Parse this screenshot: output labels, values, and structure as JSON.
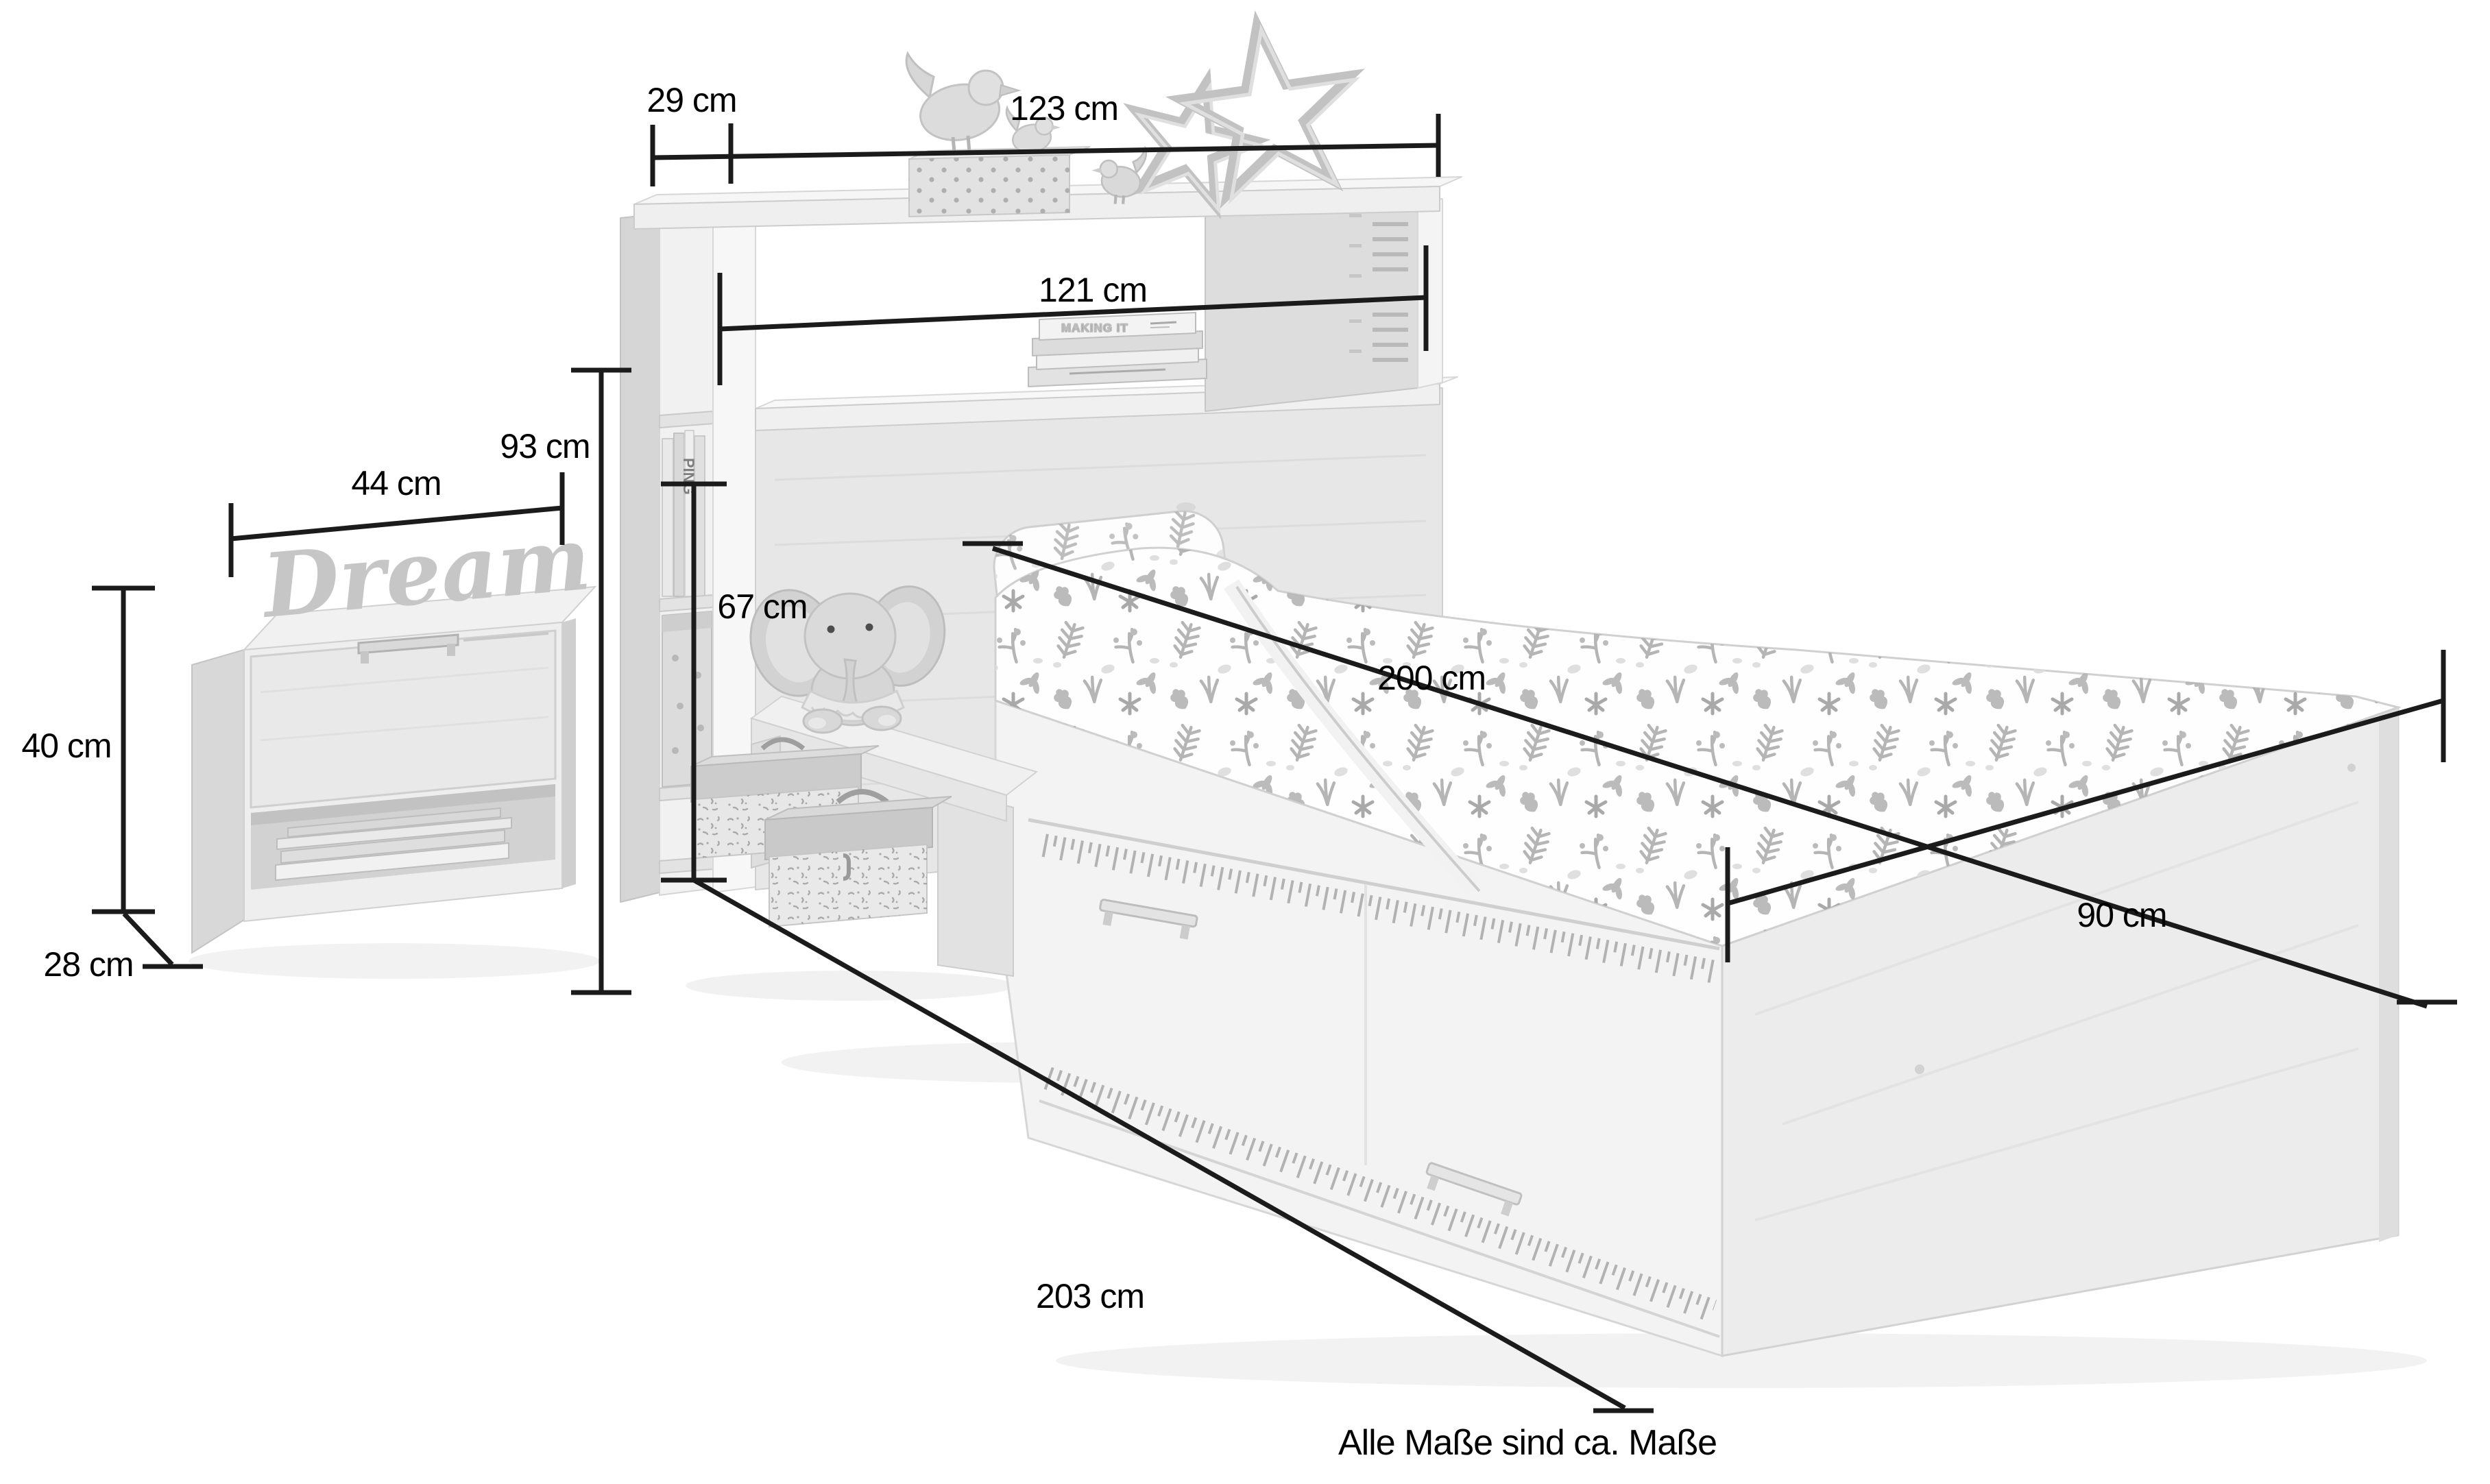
{
  "page": {
    "footnote": "Alle Maße sind ca. Maße",
    "background": "#ffffff"
  },
  "colors": {
    "dimension_line": "#1b1b1b",
    "label_text": "#000000",
    "furniture_light": "#ececec",
    "furniture_mid": "#dedede",
    "furniture_dark": "#d0d0d0",
    "pattern_leaf": "#adadad"
  },
  "measurements": {
    "top_shelf_depth": "29 cm",
    "headboard_width": "123 cm",
    "shelf_opening_width": "121 cm",
    "headboard_height": "93 cm",
    "nightstand_width": "44 cm",
    "nightstand_height": "40 cm",
    "nightstand_depth": "28 cm",
    "headboard_lower_height": "67 cm",
    "mattress_length": "200 cm",
    "bed_width": "90 cm",
    "bed_length": "203 cm"
  },
  "decor": {
    "sign_text": "Dream",
    "book_spine_top": "MAKING IT",
    "book_spine_side": "PING"
  }
}
